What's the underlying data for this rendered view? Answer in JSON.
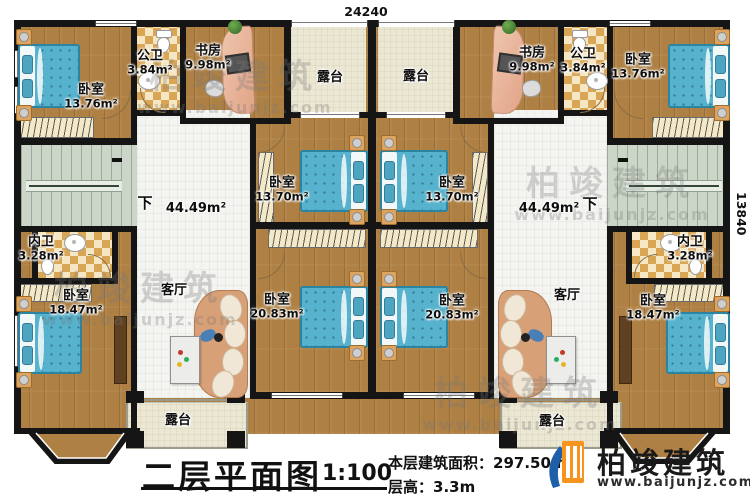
{
  "dimensions": {
    "top": "24240",
    "right": "13840"
  },
  "rooms": {
    "bedroom_tl": {
      "name": "卧室",
      "area": "13.76m²"
    },
    "bedroom_tr": {
      "name": "卧室",
      "area": "13.76m²"
    },
    "bedroom_ml": {
      "name": "卧室",
      "area": "13.70m²"
    },
    "bedroom_mr": {
      "name": "卧室",
      "area": "13.70m²"
    },
    "bedroom_bml": {
      "name": "卧室",
      "area": "20.83m²"
    },
    "bedroom_bmr": {
      "name": "卧室",
      "area": "20.83m²"
    },
    "bedroom_bl": {
      "name": "卧室",
      "area": "18.47m²"
    },
    "bedroom_br": {
      "name": "卧室",
      "area": "18.47m²"
    },
    "study_l": {
      "name": "书房",
      "area": "9.98m²"
    },
    "study_r": {
      "name": "书房",
      "area": "9.98m²"
    },
    "bath_public_l": {
      "name": "公卫",
      "area": "3.84m²"
    },
    "bath_public_r": {
      "name": "公卫",
      "area": "3.84m²"
    },
    "bath_inner_l": {
      "name": "内卫",
      "area": "3.28m²"
    },
    "bath_inner_r": {
      "name": "内卫",
      "area": "3.28m²"
    },
    "terrace_top_l": {
      "name": "露台"
    },
    "terrace_top_r": {
      "name": "露台"
    },
    "terrace_bottom_l": {
      "name": "露台"
    },
    "terrace_bottom_r": {
      "name": "露台"
    },
    "living_l": {
      "name": "客厅"
    },
    "living_r": {
      "name": "客厅"
    },
    "hall_l": {
      "area": "44.49m²",
      "stair_label": "下"
    },
    "hall_r": {
      "area": "44.49m²",
      "stair_label": "下"
    }
  },
  "title_block": {
    "title": "二层平面图",
    "scale": "1:100",
    "floor_area_label": "本层建筑面积：",
    "floor_area_value": "297.50m²",
    "floor_height_label": "层高：",
    "floor_height_value": "3.3m"
  },
  "logo": {
    "company": "柏竣建筑",
    "website": "www.baijunjz.com"
  },
  "watermark": {
    "text": "柏竣建筑",
    "website": "www.baijunjz.com"
  },
  "colors": {
    "wall": "#151515",
    "wood_floor": "#ae8044",
    "bed_blue": "#56b2cd",
    "terrace": "#ebe7d3",
    "stairs": "#ccd6c8",
    "checker_dark": "#d9a656",
    "logo_orange": "#f7941d",
    "logo_blue": "#1d5fa8"
  }
}
